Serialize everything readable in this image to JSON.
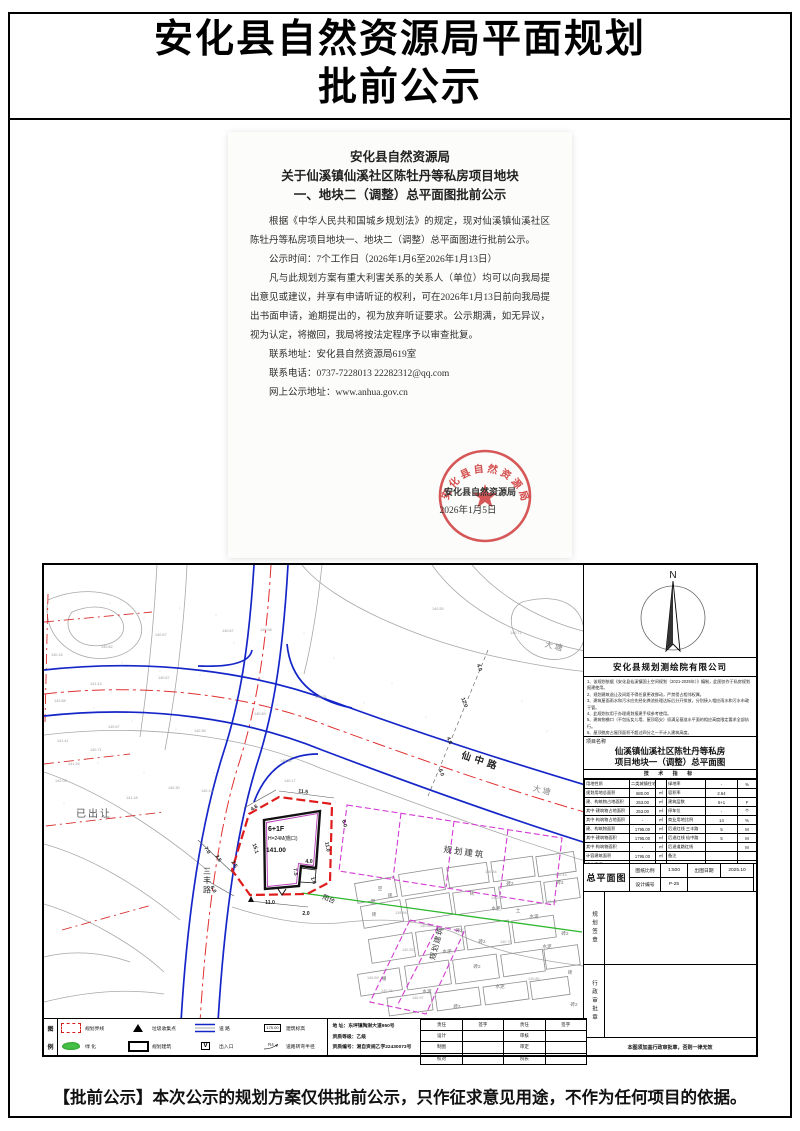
{
  "page": {
    "title_line1": "安化县自然资源局平面规划",
    "title_line2": "批前公示",
    "footer": "【批前公示】本次公示的规划方案仅供批前公示，只作征求意见用途，不作为任何项目的依据。"
  },
  "notice": {
    "heading1": "安化县自然资源局",
    "heading2": "关于仙溪镇仙溪社区陈牡丹等私房项目地块",
    "heading3": "一、地块二（调整）总平面图批前公示",
    "paragraphs": [
      "根据《中华人民共和国城乡规划法》的规定，现对仙溪镇仙溪社区陈牡丹等私房项目地块一、地块二（调整）总平面图进行批前公示。",
      "公示时间：7个工作日（2026年1月6至2026年1月13日）",
      "凡与此规划方案有重大利害关系的关系人（单位）均可以向我局提出意见或建议，并享有申请听证的权利，可在2026年1月13日前向我局提出书面申请，逾期提出的，视为放弃听证要求。公示期满，如无异议，视为认定，将撤回，我局将按法定程序予以审查批复。"
    ],
    "contact_address": "联系地址：安化县自然资源局619室",
    "contact_phone": "联系电话：0737-7228013      22282312@qq.com",
    "contact_web": "网上公示地址：www.anhua.gov.cn",
    "seal": {
      "ring_text": "安化县自然资源局",
      "sign_org": "安化县自然资源局",
      "sign_date": "2026年1月5日"
    }
  },
  "panel": {
    "north_label": "N",
    "company": "安化县规划测绘院有限公司",
    "notes": [
      "1、该规划依据《安化县仙溪镇国土空间规划（2021-2035年）》编制，此图仅作于私房规划报建使用。",
      "2、规划建筑退让及间距不得任意更改挪动，严禁侵占相邻权属。",
      "3、建筑屋面雨水和污水应先经化粪池处理达标后分开排放，分别接入相应雨水和污水市政干管。",
      "4、此规划仅用于办理规划报建手续参考使用。",
      "5、建筑物檐口（不包括女儿墙、屋顶塔尖）须满足基准水平面的相应高度限定要求全部执行。",
      "6、屋顶挑房占屋顶面积不超过四分之一不计入建筑高度。",
      "7、图中尺寸单位为“米”。",
      "8、建筑密度详见图表。"
    ],
    "project_label": "项目名称",
    "project_line1": "仙溪镇仙溪社区陈牡丹等私房",
    "project_line2": "项目地块一（调整）总平面图",
    "tech_title": "技 术 指 标",
    "tech_rows": [
      [
        "用地性质",
        "二类城镇住宅用地",
        "",
        "绿地率",
        "-",
        "%"
      ],
      [
        "规划用地总面积",
        "680.00",
        "㎡",
        "容积率",
        "2.64",
        ""
      ],
      [
        "建、构筑物占地面积",
        "253.00",
        "㎡",
        "建筑层数",
        "6+1",
        "F"
      ],
      [
        "其中·建筑物占地面积",
        "253.00",
        "㎡",
        "停车位",
        "-",
        "个"
      ],
      [
        "其中·构筑物占地面积",
        "-",
        "㎡",
        "商业用地比例",
        "14",
        "%"
      ],
      [
        "建、构筑物面积",
        "1795.00",
        "㎡",
        "后退红线 三丰路",
        "5",
        "M"
      ],
      [
        "其中·建筑物面积",
        "1795.00",
        "㎡",
        "后退红线 仙中路",
        "5",
        "M"
      ],
      [
        "其中·构筑物面积",
        "-",
        "㎡",
        "后退道路红线",
        "",
        "M"
      ],
      [
        "计容建筑面积",
        "1795.00",
        "㎡",
        "备注",
        "",
        ""
      ],
      [
        "建筑密度",
        "37",
        "%",
        "",
        "",
        ""
      ]
    ],
    "sheet": {
      "name": "总平面图",
      "scale_label": "图纸比例",
      "scale": "1:500",
      "date_label": "出图日期",
      "date": "2025.10",
      "no_label": "设计编号",
      "no": "P-25"
    },
    "stamp1": "规划签章",
    "stamp2": "行政审批章",
    "bottom_note": "本图须加盖行政审批章，否则一律无效"
  },
  "legend": {
    "col_top": "图",
    "col_bottom": "例",
    "rows": [
      [
        {
          "sym": "reddash",
          "label": "规划界线"
        },
        {
          "sym": "tri",
          "label": "垃圾收集点"
        },
        {
          "sym": "road",
          "label": "道    路"
        },
        {
          "sym": "elev",
          "symtext": "175.00",
          "label": "建筑标高"
        }
      ],
      [
        {
          "sym": "green",
          "label": "绿    化"
        },
        {
          "sym": "rect",
          "label": "规划建筑"
        },
        {
          "sym": "v",
          "symtext": "V",
          "label": "出入口"
        },
        {
          "sym": "radius",
          "symtext": "R4",
          "label": "道路转弯半径"
        }
      ]
    ]
  },
  "titleblock": {
    "address": "地    址：东坪镇陶澍大道950号",
    "grade": "资质等级：乙级",
    "cert": "资质编号：湘自资规乙字22430073号",
    "sign_headers": [
      "责任",
      "签字",
      "责任",
      "签字"
    ],
    "sign_rows": [
      [
        "设计",
        "",
        "审核",
        ""
      ],
      [
        "制图",
        "",
        "审定",
        ""
      ],
      [
        "校对",
        "",
        "院长",
        ""
      ]
    ]
  },
  "map": {
    "labels_list": [
      {
        "t": "仙中路",
        "x": 478,
        "y": 762,
        "r": 18,
        "s": 9.5,
        "c": "#222",
        "ls": 4,
        "b": 1
      },
      {
        "t": "三丰路",
        "x": 205,
        "y": 872,
        "s": 8,
        "c": "#333",
        "vert": 1
      },
      {
        "t": "已出让",
        "x": 92,
        "y": 815,
        "s": 10,
        "c": "#555",
        "ls": 2
      },
      {
        "t": "大塘",
        "x": 552,
        "y": 647,
        "r": 14,
        "s": 8,
        "c": "#8a8a8a",
        "ls": 2
      },
      {
        "t": "大塘",
        "x": 540,
        "y": 791,
        "r": 14,
        "s": 8,
        "c": "#8a8a8a",
        "ls": 2
      },
      {
        "t": "规划建筑",
        "x": 462,
        "y": 853,
        "r": 8,
        "s": 8.5,
        "c": "#333",
        "ls": 2
      },
      {
        "t": "规划建筑",
        "x": 437,
        "y": 942,
        "r": -75,
        "s": 7.5,
        "c": "#333",
        "ls": 1
      },
      {
        "t": "阳台",
        "x": 326,
        "y": 899,
        "r": 22,
        "s": 6.5,
        "c": "#222"
      },
      {
        "t": "6+1F",
        "x": 266,
        "y": 829,
        "s": 7,
        "c": "#111",
        "a": "start",
        "b": 1
      },
      {
        "t": "H=24M(檐口)",
        "x": 266,
        "y": 838,
        "s": 5,
        "c": "#111",
        "a": "start"
      },
      {
        "t": "141.00",
        "x": 264,
        "y": 850,
        "s": 6.5,
        "c": "#111",
        "a": "start",
        "b": 1
      }
    ],
    "dims": [
      [
        "4.6",
        253,
        807,
        -33
      ],
      [
        "11.5",
        301,
        791,
        7
      ],
      [
        "6.0",
        341,
        822,
        73
      ],
      [
        "11.0",
        324,
        845,
        80
      ],
      [
        "15.1",
        252,
        847,
        72
      ],
      [
        "7.0",
        204,
        849,
        58
      ],
      [
        "2.5",
        215,
        857,
        58
      ],
      [
        "2.5",
        231,
        863,
        58
      ],
      [
        "6.0",
        210,
        888,
        62
      ],
      [
        "11.0",
        268,
        902,
        0
      ],
      [
        "2.0",
        304,
        913,
        0
      ],
      [
        "7.5",
        292,
        870,
        83
      ],
      [
        "4.0",
        307,
        861,
        0
      ],
      [
        "1.6",
        310,
        879,
        70
      ],
      [
        "4.0",
        476,
        666,
        70
      ],
      [
        "12.0",
        461,
        701,
        70
      ],
      [
        "4.6",
        446,
        739,
        70
      ],
      [
        "6.0",
        438,
        771,
        70
      ]
    ],
    "spots": [
      [
        "140.16",
        49,
        654
      ],
      [
        "140.82",
        99,
        646
      ],
      [
        "140.67",
        153,
        634
      ],
      [
        "140.67",
        220,
        630
      ],
      [
        "140.58",
        258,
        629
      ],
      [
        "141.43",
        88,
        683
      ],
      [
        "142.88",
        52,
        700
      ],
      [
        "140.67",
        156,
        677
      ],
      [
        "140.67",
        106,
        726
      ],
      [
        "140.38",
        192,
        730
      ],
      [
        "141.41",
        55,
        740
      ],
      [
        "140.71",
        88,
        749
      ],
      [
        "141.26",
        66,
        763
      ],
      [
        "142.03",
        53,
        780
      ],
      [
        "140.30",
        166,
        787
      ],
      [
        "140.13",
        199,
        790
      ],
      [
        "141.18",
        124,
        797
      ],
      [
        "140.89",
        252,
        713
      ],
      [
        "140.36",
        278,
        760
      ],
      [
        "140.17",
        282,
        780
      ],
      [
        "140.31",
        313,
        696
      ],
      [
        "140.55",
        430,
        608
      ],
      [
        "140.71",
        508,
        632
      ],
      [
        "140.34",
        483,
        871
      ],
      [
        "140.43",
        553,
        874
      ],
      [
        "140.03",
        489,
        897
      ],
      [
        "139.94",
        393,
        912
      ],
      [
        "140.50",
        418,
        925
      ],
      [
        "140.33",
        400,
        949
      ],
      [
        "140.59",
        365,
        977
      ],
      [
        "140.26",
        379,
        990
      ],
      [
        "140.97",
        410,
        997
      ],
      [
        "140.79",
        498,
        941
      ],
      [
        "140.80",
        526,
        978
      ],
      [
        "140.93",
        543,
        901
      ]
    ],
    "materials": [
      [
        "空",
        378,
        888
      ],
      [
        "空",
        371,
        901
      ],
      [
        "砖",
        388,
        895
      ],
      [
        "砖",
        470,
        893
      ],
      [
        "水泥",
        494,
        908
      ],
      [
        "土",
        516,
        910
      ],
      [
        "水泥",
        532,
        916
      ],
      [
        "砖2",
        508,
        883
      ],
      [
        "砖2",
        558,
        882
      ],
      [
        "砖2",
        563,
        933
      ],
      [
        "砖",
        372,
        914
      ],
      [
        "砖2",
        457,
        930
      ],
      [
        "砖2",
        480,
        941
      ],
      [
        "水泥",
        445,
        951
      ],
      [
        "砖2",
        475,
        966
      ],
      [
        "棚",
        382,
        978
      ],
      [
        "水泥",
        425,
        991
      ],
      [
        "水泥",
        498,
        986
      ],
      [
        "砖2",
        455,
        1006
      ],
      [
        "水泥",
        545,
        946
      ],
      [
        "砖",
        568,
        972
      ],
      [
        "砖2",
        572,
        1004
      ]
    ],
    "parcels": [
      [
        374,
        888,
        40,
        20,
        -10
      ],
      [
        420,
        880,
        44,
        22,
        -9
      ],
      [
        466,
        873,
        40,
        20,
        -8
      ],
      [
        511,
        867,
        42,
        20,
        -8
      ],
      [
        554,
        862,
        38,
        20,
        -8
      ],
      [
        380,
        912,
        40,
        22,
        -10
      ],
      [
        427,
        905,
        44,
        22,
        -9
      ],
      [
        473,
        899,
        42,
        22,
        -8
      ],
      [
        519,
        893,
        42,
        22,
        -8
      ],
      [
        560,
        888,
        34,
        20,
        -8
      ],
      [
        390,
        946,
        44,
        24,
        -9
      ],
      [
        438,
        939,
        46,
        24,
        -8
      ],
      [
        486,
        933,
        44,
        24,
        -8
      ],
      [
        532,
        927,
        42,
        22,
        -8
      ],
      [
        378,
        980,
        42,
        22,
        -9
      ],
      [
        426,
        973,
        44,
        24,
        -8
      ],
      [
        474,
        967,
        44,
        24,
        -8
      ],
      [
        521,
        961,
        42,
        22,
        -8
      ],
      [
        560,
        955,
        34,
        20,
        -8
      ],
      [
        408,
        1002,
        44,
        18,
        -8
      ],
      [
        456,
        997,
        44,
        18,
        -8
      ],
      [
        504,
        991,
        44,
        18,
        -8
      ],
      [
        548,
        986,
        38,
        18,
        -8
      ]
    ],
    "marks": [
      [
        70,
        612
      ],
      [
        108,
        602
      ],
      [
        142,
        617
      ],
      [
        178,
        607
      ],
      [
        214,
        614
      ],
      [
        120,
        662
      ],
      [
        158,
        670
      ],
      [
        198,
        674
      ],
      [
        92,
        707
      ],
      [
        130,
        720
      ],
      [
        174,
        728
      ],
      [
        96,
        762
      ],
      [
        142,
        772
      ],
      [
        62,
        802
      ],
      [
        212,
        772
      ],
      [
        232,
        642
      ],
      [
        302,
        632
      ],
      [
        332,
        657
      ],
      [
        362,
        702
      ],
      [
        390,
        682
      ],
      [
        424,
        716
      ],
      [
        455,
        645
      ],
      [
        520,
        700
      ],
      [
        545,
        730
      ]
    ]
  }
}
